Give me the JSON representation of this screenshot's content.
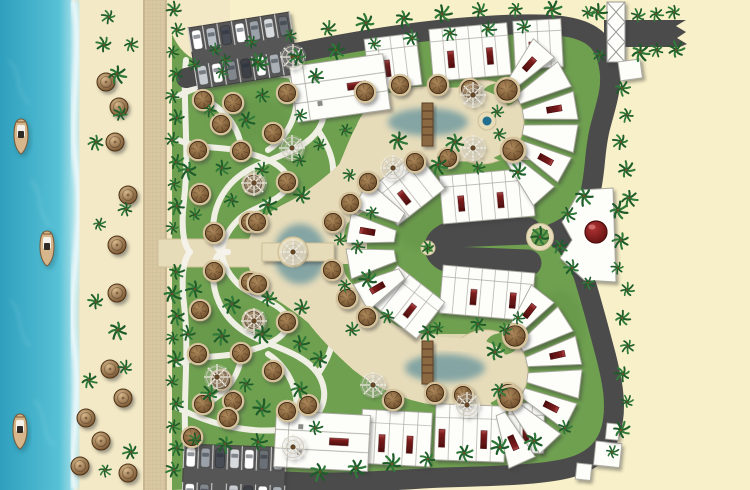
{
  "canvas": {
    "w": 750,
    "h": 490
  },
  "palette": {
    "sea1": "#57c1d6",
    "sea2": "#2e9fbd",
    "shallow": "#bfe8ee",
    "foam": "#ffffff",
    "wet": "#e9dcb4",
    "sand": "#f3e9c6",
    "sandR": "#f8f0c8",
    "bw": "#d9c7a2",
    "bwLine": "#c3b089",
    "grass": "#6fa050",
    "grassDk": "#55823b",
    "pathW": "#f6f4ec",
    "deck": "#e7dcba",
    "deckLine": "#cdbf97",
    "pool": "#3b9ab8",
    "poolDeep": "#226e8e",
    "poolRim": "#84cbdc",
    "road": "#4b4b4b",
    "roadDk": "#3c3c3c",
    "bld": "#fdfdfa",
    "bldLine": "#a9a79e",
    "maroon": "#7c1c1c",
    "maroonDk": "#4e0e0e",
    "maroonHi": "#b24a4a",
    "hutRim": "#d9c39c",
    "hut1": "#b08a5c",
    "hut2": "#6a4a28",
    "hutRing": "#3e2a14",
    "palm1": "#1e5c2a",
    "palm2": "#2f7a38",
    "trunk": "#6b4f2a",
    "dome1": "#b23434",
    "dome2": "#5c0f0f",
    "lot": "#565656",
    "stall": "#e6e6e6",
    "boatHull": "#d6b68a",
    "boatEdge": "#7a5836",
    "cabin": "#2f2a26",
    "spoke": "#efede2",
    "spokeRing": "#cfcabb",
    "log": "#8a6742",
    "logDk": "#5e4326"
  },
  "scene": {
    "boats": [
      [
        21,
        135
      ],
      [
        47,
        247
      ],
      [
        20,
        430
      ]
    ],
    "beach_umbrellas": [
      [
        106,
        82
      ],
      [
        119,
        107
      ],
      [
        115,
        142
      ],
      [
        128,
        195
      ],
      [
        117,
        245
      ],
      [
        117,
        293
      ],
      [
        110,
        369
      ],
      [
        123,
        398
      ],
      [
        86,
        418
      ],
      [
        101,
        441
      ],
      [
        80,
        466
      ],
      [
        128,
        473
      ]
    ],
    "huts": [
      [
        203,
        100
      ],
      [
        233,
        103
      ],
      [
        221,
        124
      ],
      [
        287,
        93
      ],
      [
        273,
        133
      ],
      [
        198,
        150
      ],
      [
        241,
        151
      ],
      [
        287,
        182
      ],
      [
        253,
        184
      ],
      [
        200,
        194
      ],
      [
        214,
        233
      ],
      [
        250,
        222
      ],
      [
        203,
        404
      ],
      [
        233,
        401
      ],
      [
        221,
        380
      ],
      [
        287,
        411
      ],
      [
        273,
        371
      ],
      [
        198,
        354
      ],
      [
        241,
        353
      ],
      [
        287,
        322
      ],
      [
        253,
        320
      ],
      [
        200,
        310
      ],
      [
        214,
        271
      ],
      [
        250,
        282
      ],
      [
        228,
        418
      ],
      [
        192,
        437
      ],
      [
        308,
        405
      ],
      [
        365,
        92
      ],
      [
        400,
        85
      ],
      [
        438,
        85
      ],
      [
        470,
        89
      ],
      [
        415,
        162
      ],
      [
        448,
        158
      ],
      [
        368,
        182
      ],
      [
        350,
        203
      ],
      [
        333,
        222
      ],
      [
        332,
        270
      ],
      [
        347,
        298
      ],
      [
        367,
        317
      ],
      [
        257,
        222
      ],
      [
        258,
        284
      ],
      [
        393,
        400
      ],
      [
        435,
        393
      ],
      [
        463,
        395
      ],
      [
        508,
        393
      ]
    ],
    "huts_big": [
      [
        507,
        90
      ],
      [
        513,
        150
      ],
      [
        515,
        336
      ],
      [
        510,
        398
      ]
    ],
    "spoke_umbrellas": [
      [
        293,
        57
      ],
      [
        292,
        148
      ],
      [
        254,
        183
      ],
      [
        473,
        95
      ],
      [
        473,
        148
      ],
      [
        393,
        168
      ],
      [
        373,
        385
      ],
      [
        467,
        405
      ],
      [
        217,
        377
      ],
      [
        254,
        321
      ],
      [
        293,
        447
      ],
      [
        293,
        252
      ]
    ],
    "palms": [
      [
        174,
        10
      ],
      [
        177,
        30
      ],
      [
        172,
        52
      ],
      [
        176,
        74
      ],
      [
        173,
        96
      ],
      [
        177,
        118
      ],
      [
        172,
        140
      ],
      [
        176,
        162
      ],
      [
        174,
        184
      ],
      [
        177,
        206
      ],
      [
        173,
        228
      ],
      [
        176,
        272
      ],
      [
        172,
        294
      ],
      [
        177,
        316
      ],
      [
        173,
        338
      ],
      [
        176,
        360
      ],
      [
        172,
        382
      ],
      [
        176,
        404
      ],
      [
        173,
        426
      ],
      [
        177,
        448
      ],
      [
        174,
        470
      ],
      [
        117,
        74
      ],
      [
        131,
        44
      ],
      [
        104,
        45
      ],
      [
        121,
        114
      ],
      [
        96,
        142
      ],
      [
        126,
        209
      ],
      [
        99,
        224
      ],
      [
        118,
        330
      ],
      [
        96,
        302
      ],
      [
        125,
        368
      ],
      [
        105,
        470
      ],
      [
        89,
        380
      ],
      [
        131,
        452
      ],
      [
        109,
        17
      ],
      [
        215,
        50
      ],
      [
        252,
        42
      ],
      [
        290,
        35
      ],
      [
        328,
        29
      ],
      [
        366,
        23
      ],
      [
        404,
        18
      ],
      [
        442,
        14
      ],
      [
        480,
        11
      ],
      [
        516,
        9
      ],
      [
        552,
        9
      ],
      [
        588,
        13
      ],
      [
        222,
        72
      ],
      [
        260,
        64
      ],
      [
        298,
        57
      ],
      [
        336,
        50
      ],
      [
        374,
        44
      ],
      [
        412,
        38
      ],
      [
        450,
        33
      ],
      [
        488,
        29
      ],
      [
        524,
        27
      ],
      [
        598,
        12
      ],
      [
        600,
        55
      ],
      [
        638,
        16
      ],
      [
        656,
        14
      ],
      [
        674,
        12
      ],
      [
        640,
        52
      ],
      [
        657,
        50
      ],
      [
        676,
        50
      ],
      [
        622,
        88
      ],
      [
        627,
        115
      ],
      [
        621,
        142
      ],
      [
        626,
        170
      ],
      [
        629,
        198
      ],
      [
        627,
        290
      ],
      [
        622,
        318
      ],
      [
        628,
        346
      ],
      [
        623,
        374
      ],
      [
        627,
        402
      ],
      [
        621,
        430
      ],
      [
        612,
        452
      ],
      [
        584,
        196
      ],
      [
        568,
        214
      ],
      [
        560,
        246
      ],
      [
        572,
        268
      ],
      [
        588,
        283
      ],
      [
        618,
        210
      ],
      [
        621,
        240
      ],
      [
        618,
        268
      ],
      [
        320,
        472
      ],
      [
        356,
        468
      ],
      [
        392,
        464
      ],
      [
        428,
        459
      ],
      [
        464,
        453
      ],
      [
        500,
        447
      ],
      [
        534,
        441
      ],
      [
        195,
        65
      ],
      [
        225,
        60
      ],
      [
        258,
        62
      ],
      [
        210,
        110
      ],
      [
        246,
        120
      ],
      [
        262,
        95
      ],
      [
        300,
        115
      ],
      [
        188,
        170
      ],
      [
        222,
        168
      ],
      [
        262,
        170
      ],
      [
        300,
        160
      ],
      [
        195,
        215
      ],
      [
        232,
        200
      ],
      [
        268,
        205
      ],
      [
        302,
        196
      ],
      [
        315,
        76
      ],
      [
        320,
        145
      ],
      [
        195,
        440
      ],
      [
        225,
        444
      ],
      [
        258,
        442
      ],
      [
        210,
        394
      ],
      [
        246,
        384
      ],
      [
        262,
        409
      ],
      [
        300,
        389
      ],
      [
        188,
        334
      ],
      [
        222,
        336
      ],
      [
        262,
        334
      ],
      [
        300,
        344
      ],
      [
        195,
        289
      ],
      [
        232,
        304
      ],
      [
        268,
        299
      ],
      [
        302,
        308
      ],
      [
        315,
        428
      ],
      [
        320,
        359
      ],
      [
        345,
        130
      ],
      [
        350,
        175
      ],
      [
        340,
        240
      ],
      [
        345,
        285
      ],
      [
        352,
        330
      ],
      [
        398,
        140
      ],
      [
        455,
        142
      ],
      [
        388,
        316
      ],
      [
        428,
        332
      ],
      [
        505,
        330
      ],
      [
        438,
        165
      ],
      [
        478,
        168
      ],
      [
        518,
        172
      ],
      [
        438,
        328
      ],
      [
        478,
        324
      ],
      [
        518,
        318
      ],
      [
        372,
        212
      ],
      [
        368,
        280
      ],
      [
        358,
        246
      ],
      [
        428,
        248
      ],
      [
        540,
        237
      ],
      [
        497,
        112
      ],
      [
        499,
        134
      ],
      [
        495,
        352
      ],
      [
        499,
        390
      ],
      [
        565,
        428
      ]
    ],
    "parking_lots": [
      {
        "x": 188,
        "y": 28,
        "rot": -9,
        "cols": 7,
        "rows": [
          [
            "#ffffff",
            "#b9bfc7",
            "#4a4e54",
            "#ffffff",
            "#9aa1a8",
            "#d8dbde",
            "#6a7076"
          ],
          [
            "#c8ccd1",
            "#ffffff",
            "#82878e",
            "#3d4147",
            "#ffffff",
            "#aab0b6",
            ""
          ]
        ]
      },
      {
        "x": 184,
        "y": 444,
        "rot": 2,
        "cols": 7,
        "rows": [
          [
            "#ffffff",
            "#9aa1a8",
            "#4a4e54",
            "#d8dbde",
            "#ffffff",
            "#6a7076",
            "#b9bfc7"
          ],
          [
            "#ffffff",
            "#82878e",
            "",
            "#c8ccd1",
            "#3d4147",
            "#ffffff",
            "#aab0b6"
          ]
        ]
      }
    ],
    "villa_rows": [
      {
        "cx": 393,
        "cy": 62,
        "w": 52,
        "h": 52,
        "rot": -7,
        "n": 4,
        "acc": [
          1
        ]
      },
      {
        "cx": 470,
        "cy": 52,
        "w": 78,
        "h": 52,
        "rot": -5,
        "n": 6,
        "acc": [
          1,
          4
        ]
      },
      {
        "cx": 538,
        "cy": 44,
        "w": 48,
        "h": 48,
        "rot": -3,
        "n": 4,
        "acc": [
          1
        ]
      },
      {
        "cx": 487,
        "cy": 196,
        "w": 92,
        "h": 48,
        "rot": -5,
        "n": 7,
        "acc": [
          1,
          4
        ]
      },
      {
        "cx": 487,
        "cy": 293,
        "w": 92,
        "h": 48,
        "rot": 5,
        "n": 7,
        "acc": [
          2,
          5
        ]
      },
      {
        "cx": 407,
        "cy": 189,
        "w": 60,
        "h": 46,
        "rot": -38,
        "n": 4,
        "acc": [
          1
        ]
      },
      {
        "cx": 407,
        "cy": 302,
        "w": 60,
        "h": 46,
        "rot": 38,
        "n": 4,
        "acc": [
          2
        ]
      },
      {
        "cx": 396,
        "cy": 438,
        "w": 70,
        "h": 54,
        "rot": 3,
        "n": 5,
        "acc": [
          1,
          3
        ]
      },
      {
        "cx": 470,
        "cy": 433,
        "w": 70,
        "h": 56,
        "rot": 2,
        "n": 5,
        "acc": [
          0,
          3
        ]
      },
      {
        "cx": 526,
        "cy": 428,
        "w": 36,
        "h": 50,
        "rot": 1,
        "n": 3,
        "acc": [
          1
        ]
      }
    ],
    "comb_blocks": [
      {
        "cx": 340,
        "cy": 88,
        "w": 94,
        "h": 56,
        "rot": -8
      },
      {
        "cx": 322,
        "cy": 441,
        "w": 94,
        "h": 56,
        "rot": 3
      }
    ],
    "fan_clusters": [
      {
        "cx": 478,
        "cy": 122,
        "r1": 46,
        "r2": 100,
        "a0": -58,
        "a1": 58,
        "n": 6
      },
      {
        "cx": 450,
        "cy": 246,
        "r1": 56,
        "r2": 104,
        "a0": 140,
        "a1": 220,
        "n": 4
      },
      {
        "cx": 482,
        "cy": 372,
        "r1": 46,
        "r2": 100,
        "a0": -62,
        "a1": 76,
        "n": 7
      }
    ],
    "outbuildings": [
      {
        "x": 618,
        "y": 62,
        "w": 22,
        "h": 19,
        "rot": -8
      },
      {
        "x": 596,
        "y": 441,
        "w": 26,
        "h": 24,
        "rot": 6
      },
      {
        "x": 577,
        "y": 463,
        "w": 15,
        "h": 16,
        "rot": 6
      },
      {
        "x": 607,
        "y": 423,
        "w": 13,
        "h": 16,
        "rot": 6
      }
    ],
    "roundabout": {
      "cx": 540,
      "cy": 237,
      "rOuter": 13.5,
      "rInner": 8.5
    },
    "culdesac_island": {
      "cx": 428,
      "cy": 248,
      "rOuter": 7,
      "rInner": 4.5
    },
    "dome": {
      "cx": 596,
      "cy": 232,
      "r": 11
    },
    "spa_circle": {
      "cx": 487,
      "cy": 121,
      "rOuter": 9,
      "rInner": 4.5
    },
    "pool_island": {
      "cx": 293,
      "cy": 252,
      "r": 15
    }
  }
}
